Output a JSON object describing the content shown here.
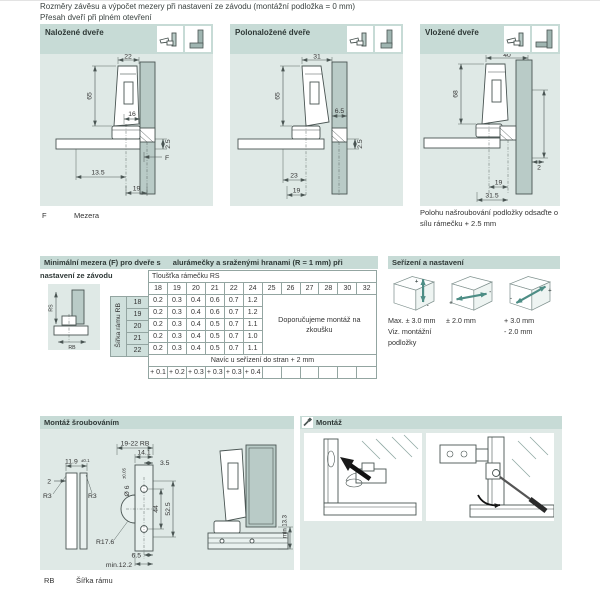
{
  "colors": {
    "section_header_bg": "#c7dbd6",
    "section_body_bg": "#dfe9e6",
    "cabinet_fill": "#b9cbc7",
    "arrow_teal": "#4d8d85",
    "table_border": "#93a5a1"
  },
  "page": {
    "title_line1": "Rozměry závěsu a výpočet mezery při nastavení ze závodu (montážní podložka = 0 mm)",
    "title_line2": "Přesah dveří při plném otevření"
  },
  "panels": [
    {
      "label": "Naložené dveře",
      "dims": {
        "top_width": "22",
        "height": "65",
        "inset": "16",
        "offset": "2.5",
        "gap": "F",
        "bottom1": "13.5",
        "bottom2": "19"
      }
    },
    {
      "label": "Polonaložené dveře",
      "dims": {
        "top_width": "31",
        "height": "65",
        "inset": "6.5",
        "offset": "2.5",
        "bottom1": "23",
        "bottom2": "19"
      }
    },
    {
      "label": "Vložené dveře",
      "dims": {
        "top_width": "40",
        "height": "68",
        "inset": "2",
        "bottom1": "19",
        "bottom2": "31.5"
      }
    }
  ],
  "legend": {
    "f_key": "F",
    "f_label": "Mezera",
    "right_note": "Polohu našroubování podložky odsaďte o sílu rámečku + 2.5 mm"
  },
  "gap_table": {
    "title_part1": "Minimální mezera (F) pro dveře s",
    "title_part2": "alurámečky a sraženými hranami (R = 1 mm) při nastavení ze závodu",
    "col_group_label": "Tloušťka rámečku RS",
    "row_group_label": "Šířka rámu RB",
    "columns": [
      "18",
      "19",
      "20",
      "21",
      "22",
      "24",
      "25",
      "26",
      "27",
      "28",
      "30",
      "32"
    ],
    "rows": [
      {
        "label": "18",
        "values": [
          "0.2",
          "0.3",
          "0.4",
          "0.6",
          "0.7",
          "1.2"
        ]
      },
      {
        "label": "19",
        "values": [
          "0.2",
          "0.3",
          "0.4",
          "0.6",
          "0.7",
          "1.2"
        ]
      },
      {
        "label": "20",
        "values": [
          "0.2",
          "0.3",
          "0.4",
          "0.5",
          "0.7",
          "1.1"
        ]
      },
      {
        "label": "21",
        "values": [
          "0.2",
          "0.3",
          "0.4",
          "0.5",
          "0.7",
          "1.0"
        ]
      },
      {
        "label": "22",
        "values": [
          "0.2",
          "0.3",
          "0.4",
          "0.5",
          "0.7",
          "1.1"
        ]
      }
    ],
    "recommendation_line1": "Doporučujeme montáž na",
    "recommendation_line2": "zkoušku",
    "extra_row_label": "Navíc u seřízení do stran + 2 mm",
    "extra_values": [
      "+ 0.1",
      "+ 0.2",
      "+ 0.3",
      "+ 0.3",
      "+ 0.3",
      "+ 0.4"
    ],
    "diagram": {
      "rs": "RS",
      "rb": "RB"
    }
  },
  "adjustment": {
    "title": "Seřízení a nastavení",
    "items": [
      {
        "line1": "Max. ± 3.0 mm",
        "line2": "Viz. montážní",
        "line3": "podložky",
        "plus": "+",
        "minus": "-"
      },
      {
        "line1": "± 2.0 mm",
        "plus": "+",
        "minus": "-"
      },
      {
        "line1": "+ 3.0 mm",
        "line2": "- 2.0 mm",
        "plus": "+",
        "minus": "-"
      }
    ]
  },
  "mounting": {
    "title": "Montáž šroubováním",
    "profile": {
      "width": "11.9",
      "width_tol": "±0.1",
      "edge": "2",
      "r_left": "R3",
      "r_right": "R3"
    },
    "plate": {
      "rb_range": "19-22 RB",
      "w1": "14.1",
      "w2": "3.5",
      "hole_dia": "Ø 6",
      "hole_tol": "±0.05",
      "hole_spacing": "44",
      "plate_span": "52.5",
      "radius": "R17.6",
      "b1": "6.5",
      "b2": "min.12.2"
    },
    "side": {
      "min_clearance": "min 13.3"
    },
    "legend_key": "RB",
    "legend_label": "Šířka rámu"
  },
  "assembly": {
    "title": "Montáž"
  }
}
